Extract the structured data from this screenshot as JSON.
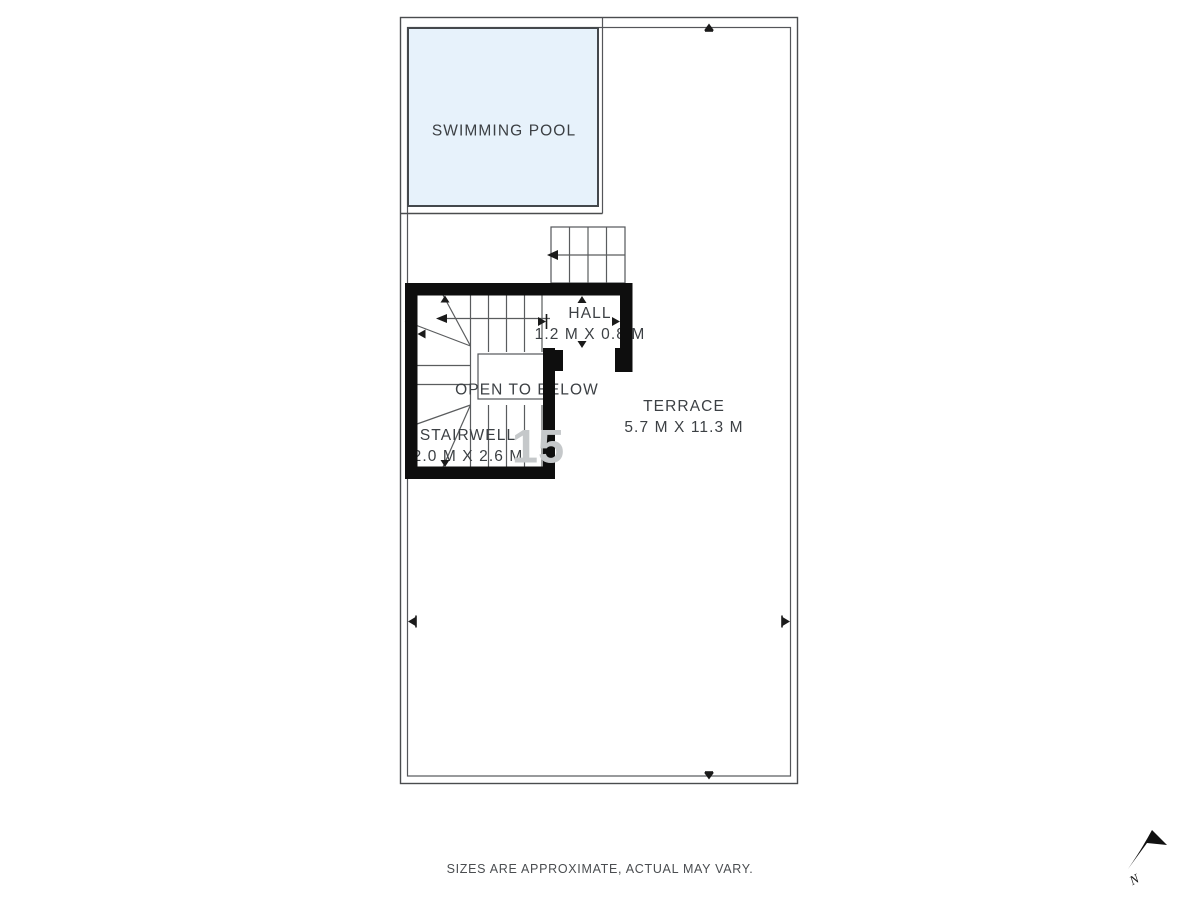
{
  "plan": {
    "rooms": [
      {
        "id": "swimming-pool",
        "name": "SWIMMING POOL",
        "dims": ""
      },
      {
        "id": "hall",
        "name": "HALL",
        "dims": "1.2 M X 0.8 M"
      },
      {
        "id": "open-to-below",
        "name": "OPEN TO BELOW",
        "dims": ""
      },
      {
        "id": "stairwell",
        "name": "STAIRWELL",
        "dims": "2.0 M X 2.6 M"
      },
      {
        "id": "terrace",
        "name": "TERRACE",
        "dims": "5.7 M X 11.3 M"
      }
    ],
    "watermark": "15",
    "north_label": "N",
    "disclaimer": "SIZES ARE APPROXIMATE, ACTUAL MAY VARY.",
    "colors": {
      "pool_fill": "#e7f2fb",
      "line": "#4a4c4e",
      "wall": "#0e0e0e",
      "text": "#3c4044"
    }
  }
}
